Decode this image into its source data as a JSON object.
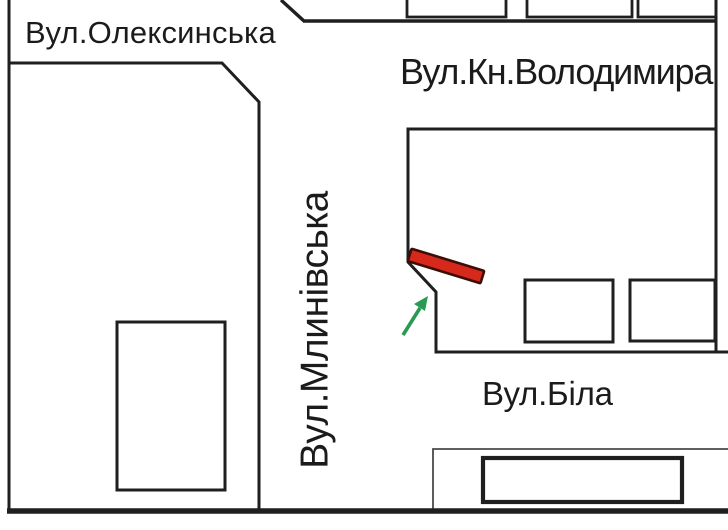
{
  "map": {
    "background": "#ffffff",
    "line_color": "#1f1f1f",
    "thin_line_color": "#4a4a4a"
  },
  "streets": {
    "oleksynska": "Вул.Олексинська",
    "kn_volodymyra": "Вул.Кн.Володимира",
    "mlynivska": "Вул.Млинівська",
    "bila": "Вул.Біла"
  },
  "marker": {
    "fill": "#d6291c",
    "outline": "#3f0d08"
  },
  "arrow": {
    "color": "#2a9a52"
  }
}
